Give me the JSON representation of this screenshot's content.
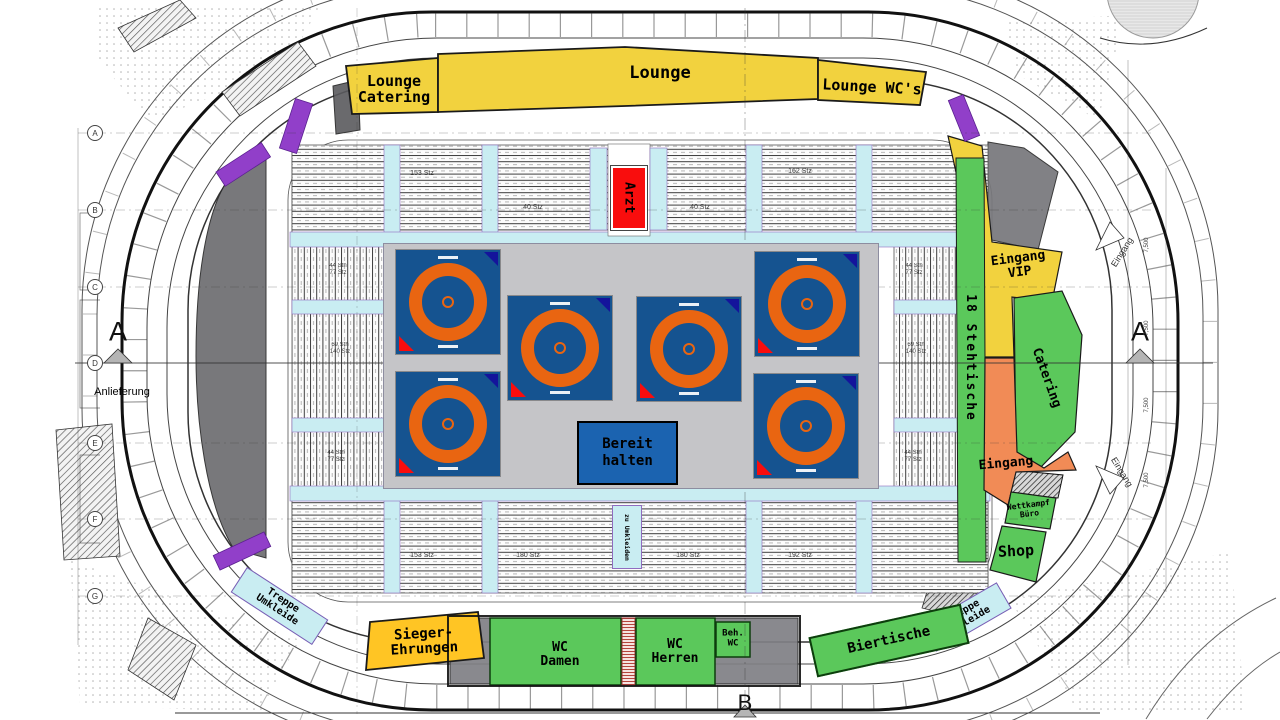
{
  "colors": {
    "yellow": "#F2D23E",
    "gold": "#FFC524",
    "green": "#5BC85B",
    "orange": "#F18B56",
    "red": "#F90D0D",
    "purple": "#913FC9",
    "cyan": "#C9EDF2",
    "mat_blue": "#155390",
    "mat_ring": "#E96511",
    "field_gray": "#C5C5C8",
    "hold_blue": "#1B63B0",
    "dark_zone": "#6E6E72",
    "gray_zone": "#808085"
  },
  "zones": {
    "lounge_catering": {
      "line1": "Lounge",
      "line2": "Catering"
    },
    "lounge": {
      "label": "Lounge"
    },
    "lounge_wcs": {
      "label": "Lounge WC's"
    },
    "arzt": {
      "label": "Arzt"
    },
    "eingang_vip": {
      "line1": "Eingang",
      "line2": "VIP"
    },
    "stehtische": {
      "label": "18 Stehtische"
    },
    "catering_right": {
      "label": "Catering"
    },
    "eingang_right": {
      "label": "Eingang"
    },
    "wettkampf_buero": {
      "line1": "Wettkampf",
      "line2": "Büro"
    },
    "shop": {
      "label": "Shop"
    },
    "treppe_umkleide_right": {
      "line1": "Treppe",
      "line2": "Umkleide"
    },
    "biertische": {
      "label": "Biertische"
    },
    "beh_wc": {
      "line1": "Beh.",
      "line2": "WC"
    },
    "wc_herren": {
      "line1": "WC",
      "line2": "Herren"
    },
    "wc_damen": {
      "line1": "WC",
      "line2": "Damen"
    },
    "sieger_ehrungen": {
      "line1": "Sieger-",
      "line2": "Ehrungen"
    },
    "treppe_umkleide_left": {
      "line1": "Treppe",
      "line2": "Umkleide"
    },
    "bereit_halten": {
      "line1": "Bereit",
      "line2": "halten"
    },
    "zu_umkleiden": {
      "label": "zu Umkleiden"
    }
  },
  "annotations": {
    "anlieferung": "Anlieferung",
    "section_a": "A",
    "section_b": "B",
    "eingang": "Eingang",
    "dim_7500": "7,500",
    "grid_letters": [
      "A",
      "B",
      "C",
      "D",
      "E",
      "F",
      "G"
    ]
  },
  "seat_counts": {
    "top": [
      "153 Stz",
      "40 Stz",
      "40 Stz",
      "162 Stz"
    ],
    "bottom": [
      "153 Stz",
      "180 Stz",
      "180 Stz",
      "192 Stz"
    ],
    "left": [
      {
        "l1": "44 Sth",
        "l2": "77 Stz"
      },
      {
        "l1": "69 Sth",
        "l2": "140 Stz"
      },
      {
        "l1": "44 Sth",
        "l2": "77 Stz"
      }
    ],
    "right": [
      {
        "l1": "44 Sth",
        "l2": "77 Stz"
      },
      {
        "l1": "69 Sth",
        "l2": "140 Stz"
      },
      {
        "l1": "44 Sth",
        "l2": "77 Stz"
      }
    ]
  },
  "mats_count": 6
}
